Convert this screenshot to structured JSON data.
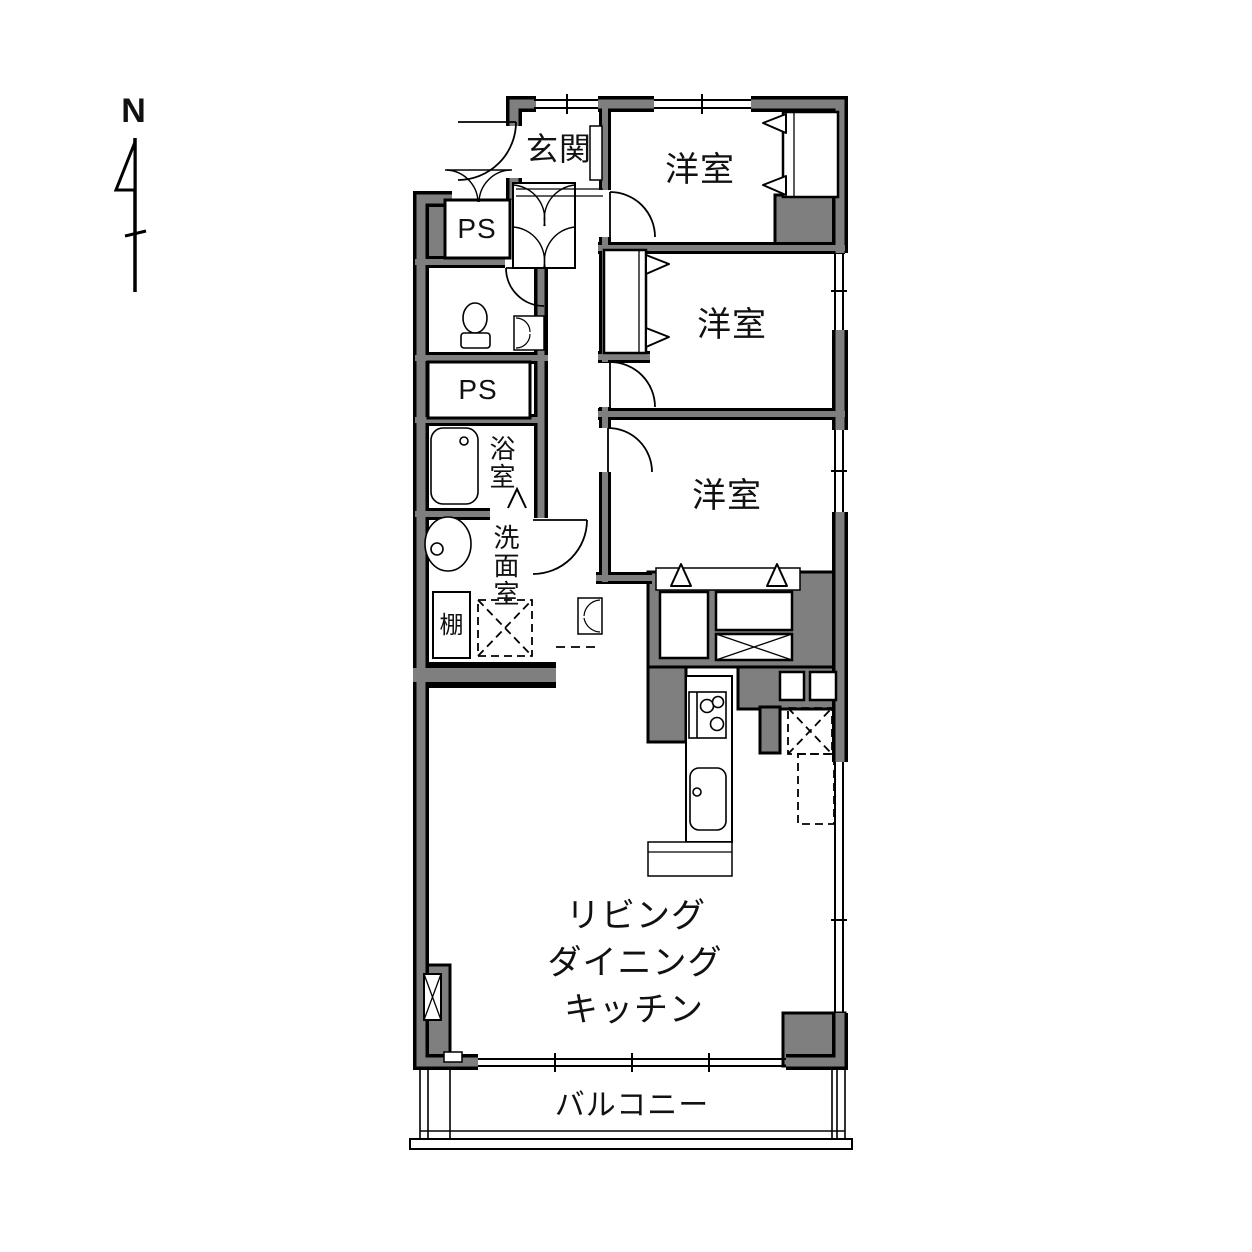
{
  "compass": {
    "north_label": "N"
  },
  "labels": {
    "entrance": "玄関",
    "bedroom_1": "洋室",
    "bedroom_2": "洋室",
    "bedroom_3": "洋室",
    "pipe_space_1": "PS",
    "pipe_space_2": "PS",
    "bathroom": "浴室",
    "washroom": "洗面室",
    "shelf": "棚",
    "ldk_line_1": "リビング",
    "ldk_line_2": "ダイニング",
    "ldk_line_3": "キッチン",
    "balcony": "バルコニー"
  },
  "fixtures": [
    "toilet",
    "bathtub",
    "washbasin",
    "kitchen-stove",
    "kitchen-sink",
    "washing-machine-space",
    "refrigerator-space",
    "shoe-cabinet",
    "closet-sliding-doors",
    "windows",
    "balcony-sliding-door",
    "north-arrow"
  ],
  "colors": {
    "wall_fill": "#7f7f7f",
    "line": "#000000",
    "floor": "#ffffff"
  }
}
